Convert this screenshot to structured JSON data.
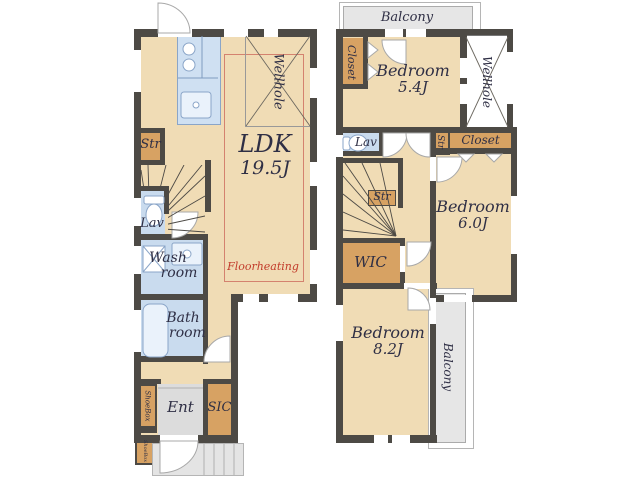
{
  "title": "2-story house floor plan",
  "colors": {
    "wall": "#4d4a45",
    "floor": "#f0dcb5",
    "storage": "#d7a263",
    "wet": "#c9dbee",
    "kitchen": "#cfe0f2",
    "balcony": "#e6e6e6",
    "entry": "#dcdcdc",
    "porch": "#e4e4e4",
    "red": "#c23b2a",
    "text": "#2f2f45",
    "fixture": "#8aa5c8",
    "outline": "#b5b5b5"
  },
  "floor1": {
    "ldk_name": "LDK",
    "ldk_size": "19.5J",
    "floorheating": "Floorheating",
    "wellhole": "Wellhole",
    "str": "Str",
    "lav": "Lav",
    "wash_line1": "Wash",
    "wash_line2": "room",
    "bath_line1": "Bath",
    "bath_line2": "room",
    "shoebox": "ShoeBox",
    "shoebox_small": "ShoeBox",
    "ent": "Ent",
    "sic": "SIC"
  },
  "floor2": {
    "balcony_top": "Balcony",
    "closet_top": "Closet",
    "bedroom1_name": "Bedroom",
    "bedroom1_size": "5.4J",
    "wellhole": "Wellhole",
    "lav": "Lav",
    "str_box": "Str",
    "closet_right": "Closet",
    "bedroom2_name": "Bedroom",
    "bedroom2_size": "6.0J",
    "str_stairs": "Str",
    "wic": "WIC",
    "bedroom3_name": "Bedroom",
    "bedroom3_size": "8.2J",
    "balcony_right": "Balcony"
  }
}
